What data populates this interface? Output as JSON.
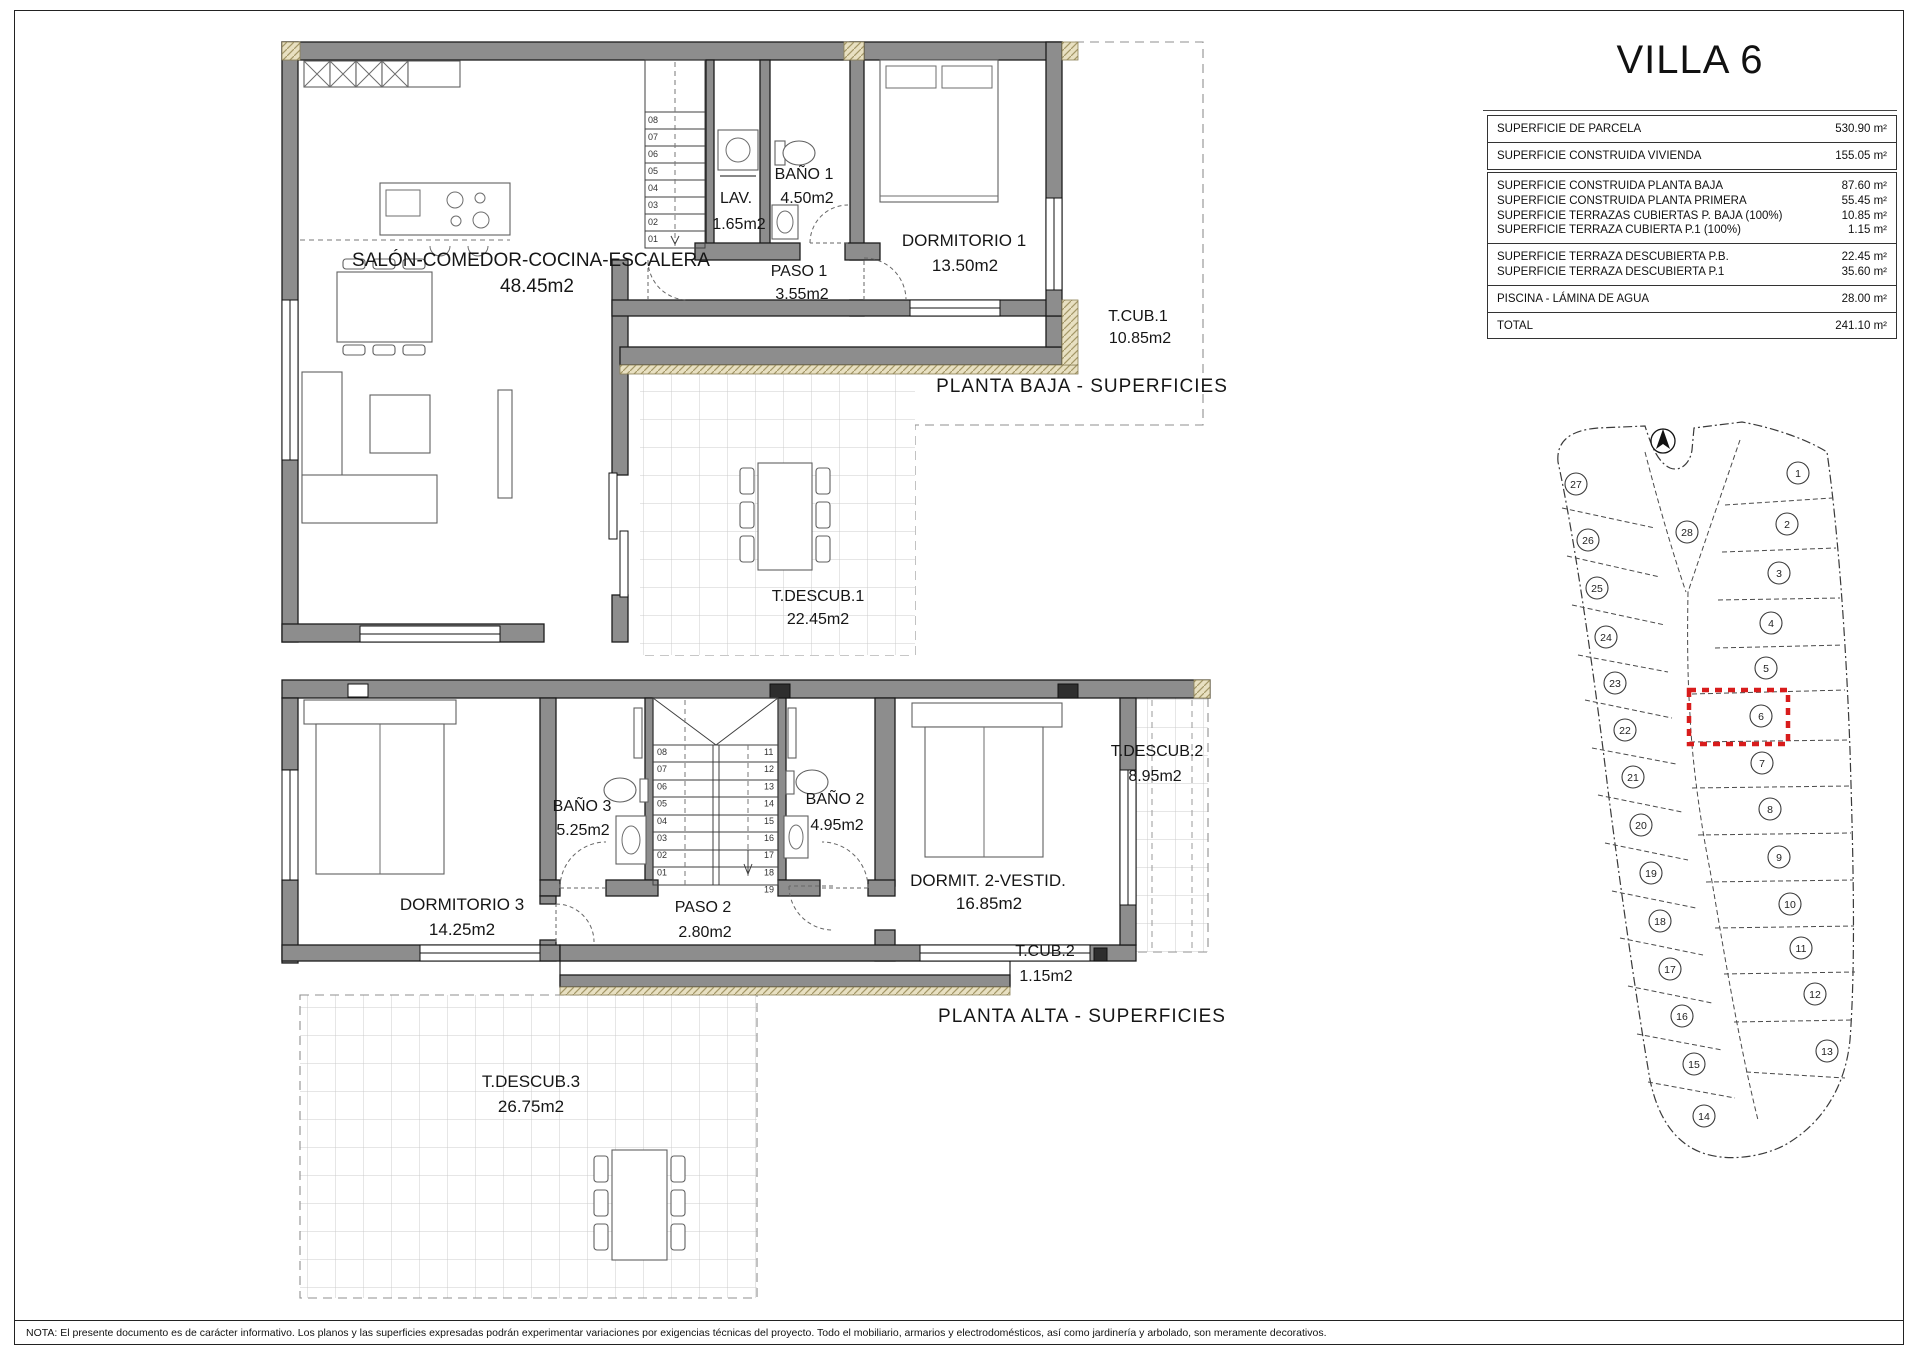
{
  "page": {
    "title": "VILLA 6",
    "footer_note": "NOTA: El presente documento es de carácter informativo. Los planos y las superficies expresadas podrán experimentar variaciones por exigencias técnicas del proyecto. Todo el mobiliario, armarios y electrodomésticos, así como jardinería y arbolado, son meramente decorativos."
  },
  "surface_table": {
    "box1": [
      {
        "label": "SUPERFICIE DE PARCELA",
        "value": "530.90 m²"
      },
      {
        "label": "SUPERFICIE CONSTRUIDA VIVIENDA",
        "value": "155.05 m²"
      }
    ],
    "box2": [
      [
        {
          "label": "SUPERFICIE CONSTRUIDA PLANTA BAJA",
          "value": "87.60 m²"
        },
        {
          "label": "SUPERFICIE CONSTRUIDA PLANTA PRIMERA",
          "value": "55.45 m²"
        },
        {
          "label": "SUPERFICIE TERRAZAS CUBIERTAS P. BAJA (100%)",
          "value": "10.85 m²"
        },
        {
          "label": "SUPERFICIE TERRAZA CUBIERTA P.1 (100%)",
          "value": "1.15 m²"
        }
      ],
      [
        {
          "label": "SUPERFICIE TERRAZA DESCUBIERTA P.B.",
          "value": "22.45 m²"
        },
        {
          "label": "SUPERFICIE TERRAZA DESCUBIERTA P.1",
          "value": "35.60 m²"
        }
      ],
      [
        {
          "label": "PISCINA - LÁMINA DE AGUA",
          "value": "28.00 m²"
        }
      ],
      [
        {
          "label": "TOTAL",
          "value": "241.10 m²"
        }
      ]
    ]
  },
  "plans": {
    "baja": {
      "title": "PLANTA BAJA - SUPERFICIES",
      "rooms": {
        "salon": {
          "name": "SALÓN-COMEDOR-COCINA-ESCALERA",
          "area": "48.45m2"
        },
        "lav": {
          "name": "LAV.",
          "area": "1.65m2"
        },
        "bano1": {
          "name": "BAÑO 1",
          "area": "4.50m2"
        },
        "paso1": {
          "name": "PASO 1",
          "area": "3.55m2"
        },
        "dorm1": {
          "name": "DORMITORIO 1",
          "area": "13.50m2"
        },
        "tcub1": {
          "name": "T.CUB.1",
          "area": "10.85m2"
        },
        "tdescub1": {
          "name": "T.DESCUB.1",
          "area": "22.45m2"
        }
      },
      "stair_left": [
        "08",
        "07",
        "06",
        "05",
        "04",
        "03",
        "02",
        "01"
      ]
    },
    "alta": {
      "title": "PLANTA ALTA - SUPERFICIES",
      "rooms": {
        "dorm3": {
          "name": "DORMITORIO 3",
          "area": "14.25m2"
        },
        "bano3": {
          "name": "BAÑO 3",
          "area": "5.25m2"
        },
        "bano2": {
          "name": "BAÑO 2",
          "area": "4.95m2"
        },
        "paso2": {
          "name": "PASO 2",
          "area": "2.80m2"
        },
        "dorm2": {
          "name": "DORMIT. 2-VESTID.",
          "area": "16.85m2"
        },
        "tdescub2": {
          "name": "T.DESCUB.2",
          "area": "8.95m2"
        },
        "tcub2": {
          "name": "T.CUB.2",
          "area": "1.15m2"
        },
        "tdescub3": {
          "name": "T.DESCUB.3",
          "area": "26.75m2"
        }
      },
      "stair_left": [
        "08",
        "07",
        "06",
        "05",
        "04",
        "03",
        "02",
        "01"
      ],
      "stair_right": [
        "11",
        "12",
        "13",
        "14",
        "15",
        "16",
        "17",
        "18",
        "19"
      ]
    }
  },
  "site_plan": {
    "plots": [
      "1",
      "2",
      "3",
      "4",
      "5",
      "6",
      "7",
      "8",
      "9",
      "10",
      "11",
      "12",
      "13",
      "14",
      "15",
      "16",
      "17",
      "18",
      "19",
      "20",
      "21",
      "22",
      "23",
      "24",
      "25",
      "26",
      "27",
      "28"
    ],
    "highlighted_plot": "6"
  }
}
